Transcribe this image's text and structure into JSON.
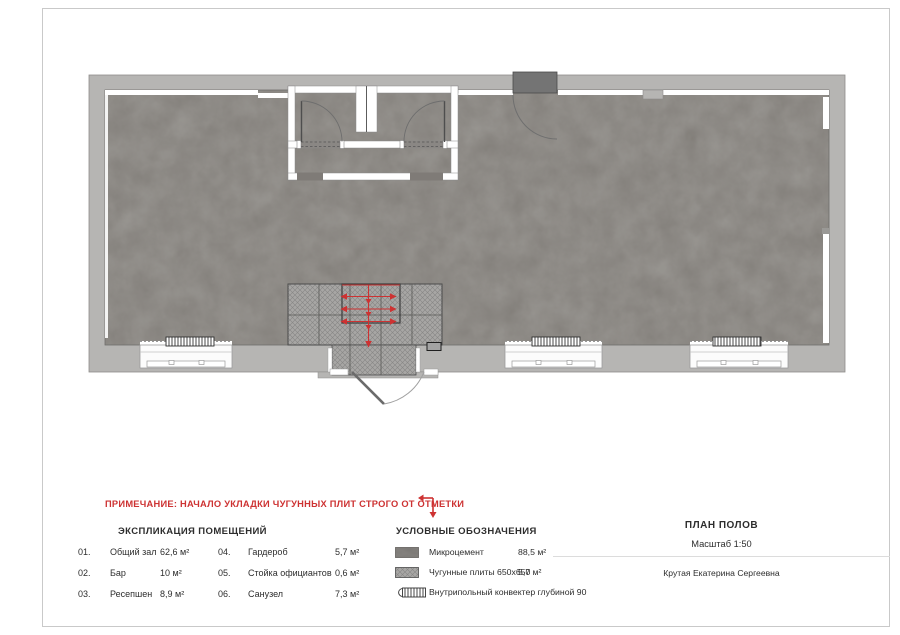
{
  "colors": {
    "accent-red": "#cd3232",
    "text-dark": "#2d2d2d",
    "wall-gray": "#b6b5b3",
    "floor-gray": "#7b7772",
    "frame-gray": "#c9c9c9"
  },
  "note": {
    "text": "ПРИМЕЧАНИЕ: НАЧАЛО УКЛАДКИ ЧУГУННЫХ ПЛИТ СТРОГО ОТ ОТМЕТКИ"
  },
  "explication": {
    "title": "ЭКСПЛИКАЦИЯ ПОМЕЩЕНИЙ",
    "rows_left": [
      {
        "num": "01.",
        "name": "Общий зал",
        "area": "62,6 м²"
      },
      {
        "num": "02.",
        "name": "Бар",
        "area": "10 м²"
      },
      {
        "num": "03.",
        "name": "Ресепшен",
        "area": "8,9 м²"
      }
    ],
    "rows_right": [
      {
        "num": "04.",
        "name": "Гардероб",
        "area": "5,7 м²"
      },
      {
        "num": "05.",
        "name": "Стойка официантов",
        "area": "0,6 м²"
      },
      {
        "num": "06.",
        "name": "Санузел",
        "area": "7,3 м²"
      }
    ]
  },
  "legend": {
    "title": "УСЛОВНЫЕ ОБОЗНАЧЕНИЯ",
    "items": [
      {
        "swatch": "microcement-swatch",
        "label": "Микроцемент",
        "area": "88,5 м²"
      },
      {
        "swatch": "cast-iron-tiles-swatch",
        "label": "Чугунные плиты 650х650",
        "area": "5,7 м²"
      },
      {
        "swatch": "floor-convector-swatch",
        "label": "Внутрипольный конвектер глубиной 90",
        "area": ""
      }
    ]
  },
  "titleblock": {
    "title": "ПЛАН ПОЛОВ",
    "scale": "Масштаб 1:50",
    "author": "Крутая Екатерина Сергеевна"
  }
}
